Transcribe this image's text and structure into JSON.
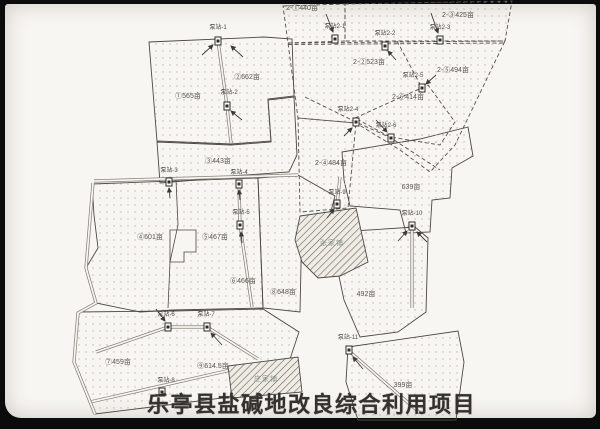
{
  "title": "乐亭县盐碱地改良综合利用项目",
  "map": {
    "parcel_labels": [
      {
        "text": "①565亩",
        "x": 188,
        "y": 96
      },
      {
        "text": "②662亩",
        "x": 247,
        "y": 77
      },
      {
        "text": "③443亩",
        "x": 218,
        "y": 161
      },
      {
        "text": "④601亩",
        "x": 150,
        "y": 237
      },
      {
        "text": "⑤467亩",
        "x": 215,
        "y": 237
      },
      {
        "text": "⑥466亩",
        "x": 243,
        "y": 281
      },
      {
        "text": "⑦459亩",
        "x": 118,
        "y": 362
      },
      {
        "text": "⑧648亩",
        "x": 283,
        "y": 292
      },
      {
        "text": "⑨614.5亩",
        "x": 213,
        "y": 366
      },
      {
        "text": "639亩",
        "x": 411,
        "y": 187
      },
      {
        "text": "492亩",
        "x": 366,
        "y": 294
      },
      {
        "text": "399亩",
        "x": 403,
        "y": 385
      },
      {
        "text": "2-①440亩",
        "x": 302,
        "y": 8
      },
      {
        "text": "2-②523亩",
        "x": 369,
        "y": 62
      },
      {
        "text": "2-③425亩",
        "x": 458,
        "y": 15
      },
      {
        "text": "2-④484亩",
        "x": 331,
        "y": 163
      },
      {
        "text": "2-⑤494亩",
        "x": 453,
        "y": 70
      },
      {
        "text": "2-⑥414亩",
        "x": 408,
        "y": 97
      }
    ],
    "pump_stations": [
      {
        "label": "泵站-1",
        "lx": 218,
        "ly": 31,
        "ix": 218,
        "iy": 41
      },
      {
        "label": "泵站-2",
        "lx": 229,
        "ly": 96,
        "ix": 227,
        "iy": 106
      },
      {
        "label": "泵站-3",
        "lx": 169,
        "ly": 174,
        "ix": 169,
        "iy": 182
      },
      {
        "label": "泵站-4",
        "lx": 239,
        "ly": 176,
        "ix": 239,
        "iy": 184
      },
      {
        "label": "泵站-5",
        "lx": 241,
        "ly": 216,
        "ix": 240,
        "iy": 225
      },
      {
        "label": "泵站-6",
        "lx": 166,
        "ly": 318,
        "ix": 168,
        "iy": 327
      },
      {
        "label": "泵站-7",
        "lx": 206,
        "ly": 318,
        "ix": 207,
        "iy": 327
      },
      {
        "label": "泵站-8",
        "lx": 166,
        "ly": 384,
        "ix": 162,
        "iy": 392
      },
      {
        "label": "泵站-9",
        "lx": 337,
        "ly": 196,
        "ix": 337,
        "iy": 204
      },
      {
        "label": "泵站-10",
        "lx": 412,
        "ly": 217,
        "ix": 412,
        "iy": 226
      },
      {
        "label": "泵站-11",
        "lx": 348,
        "ly": 341,
        "ix": 349,
        "iy": 350
      },
      {
        "label": "泵站2-1",
        "lx": 335,
        "ly": 30,
        "ix": 335,
        "iy": 39
      },
      {
        "label": "泵站2-2",
        "lx": 385,
        "ly": 37,
        "ix": 385,
        "iy": 46
      },
      {
        "label": "泵站2-3",
        "lx": 440,
        "ly": 31,
        "ix": 440,
        "iy": 40
      },
      {
        "label": "泵站2-4",
        "lx": 348,
        "ly": 113,
        "ix": 356,
        "iy": 122
      },
      {
        "label": "泵站2-5",
        "lx": 413,
        "ly": 79,
        "ix": 422,
        "iy": 88
      },
      {
        "label": "泵站2-6",
        "lx": 386,
        "ly": 129,
        "ix": 391,
        "iy": 138
      }
    ],
    "villages": [
      {
        "name": "张家铺",
        "x": 332,
        "y": 243
      },
      {
        "name": "庄家铺",
        "x": 266,
        "y": 379
      }
    ]
  }
}
